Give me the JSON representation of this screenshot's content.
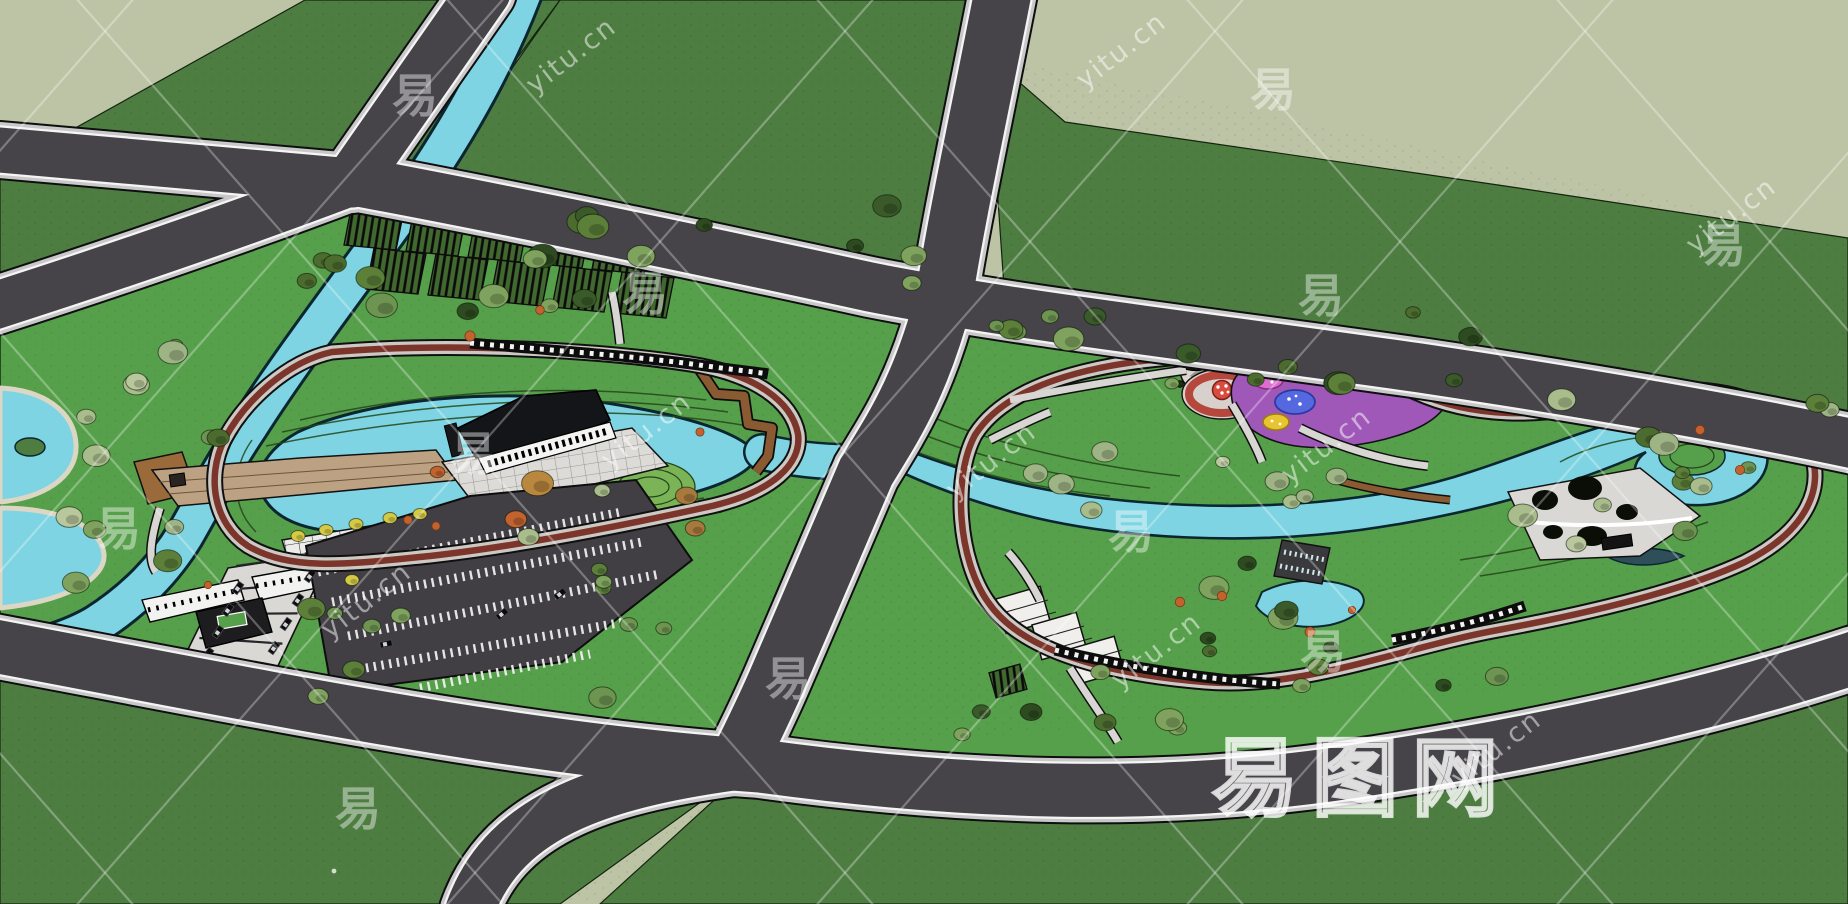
{
  "watermark": {
    "glyph": "易",
    "site": "yitu.cn",
    "brand": "易图网"
  },
  "palette": {
    "backdrop": "#bdc4a6",
    "field_green": "#4e7d42",
    "park_green": "#57a04b",
    "water_blue": "#7ed4e2",
    "water_edge": "#0b2630",
    "road_asphalt": "#464349",
    "road_sidewalk": "#c8c8c8",
    "path_red": "#7c352a",
    "walk_gray": "#d8d6d2",
    "deck_tan": "#bda183",
    "plaza_light": "#e2e1dd",
    "playground_purple": "#9f58b8",
    "ring_red": "#b5473c",
    "boardwalk_brown": "#8a5a33",
    "glass_green": "#d8e6de",
    "tree_yellow": "#d6ca45",
    "shrub_orange": "#c2622f",
    "contour_dark": "#24461b"
  }
}
